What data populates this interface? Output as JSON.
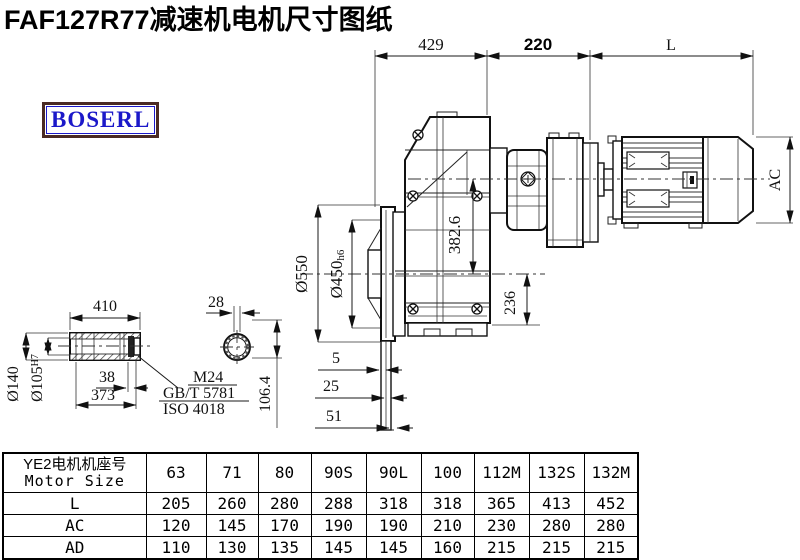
{
  "page": {
    "title": "FAF127R77减速机电机尺寸图纸"
  },
  "logo": {
    "text": "BOSERL"
  },
  "colors": {
    "line": "#111111",
    "logo_border": "#4a2a23",
    "logo_text": "#1b18c9"
  },
  "dims": {
    "top_left": "429",
    "top_mid": "220",
    "top_right": "L",
    "motor_height": "AC",
    "axis_to_output": "382.6",
    "output_to_bottom": "236",
    "flange_od": "Ø550",
    "flange_spigot": "Ø450",
    "flange_spigot_tol": "h6",
    "flange_step1": "5",
    "flange_step2": "25",
    "flange_step3": "51",
    "shaft_length": "410",
    "section_width": "28",
    "shaft_od": "Ø140",
    "shaft_bore": "Ø105",
    "shaft_bore_tol": "H7",
    "shaft_end": "38",
    "shaft_inner_len": "373",
    "note_line1": "M24",
    "note_line2": "GB/T 5781",
    "note_line3": "ISO 4018",
    "section_height": "106.4"
  },
  "table": {
    "header_cn": "YE2电机机座号",
    "header_en": "Motor Size",
    "columns": [
      "63",
      "71",
      "80",
      "90S",
      "90L",
      "100",
      "112M",
      "132S",
      "132M"
    ],
    "rows": [
      {
        "label": "L",
        "values": [
          "205",
          "260",
          "280",
          "288",
          "318",
          "318",
          "365",
          "413",
          "452"
        ]
      },
      {
        "label": "AC",
        "values": [
          "120",
          "145",
          "170",
          "190",
          "190",
          "210",
          "230",
          "280",
          "280"
        ]
      },
      {
        "label": "AD",
        "values": [
          "110",
          "130",
          "135",
          "145",
          "145",
          "160",
          "215",
          "215",
          "215"
        ]
      }
    ]
  }
}
